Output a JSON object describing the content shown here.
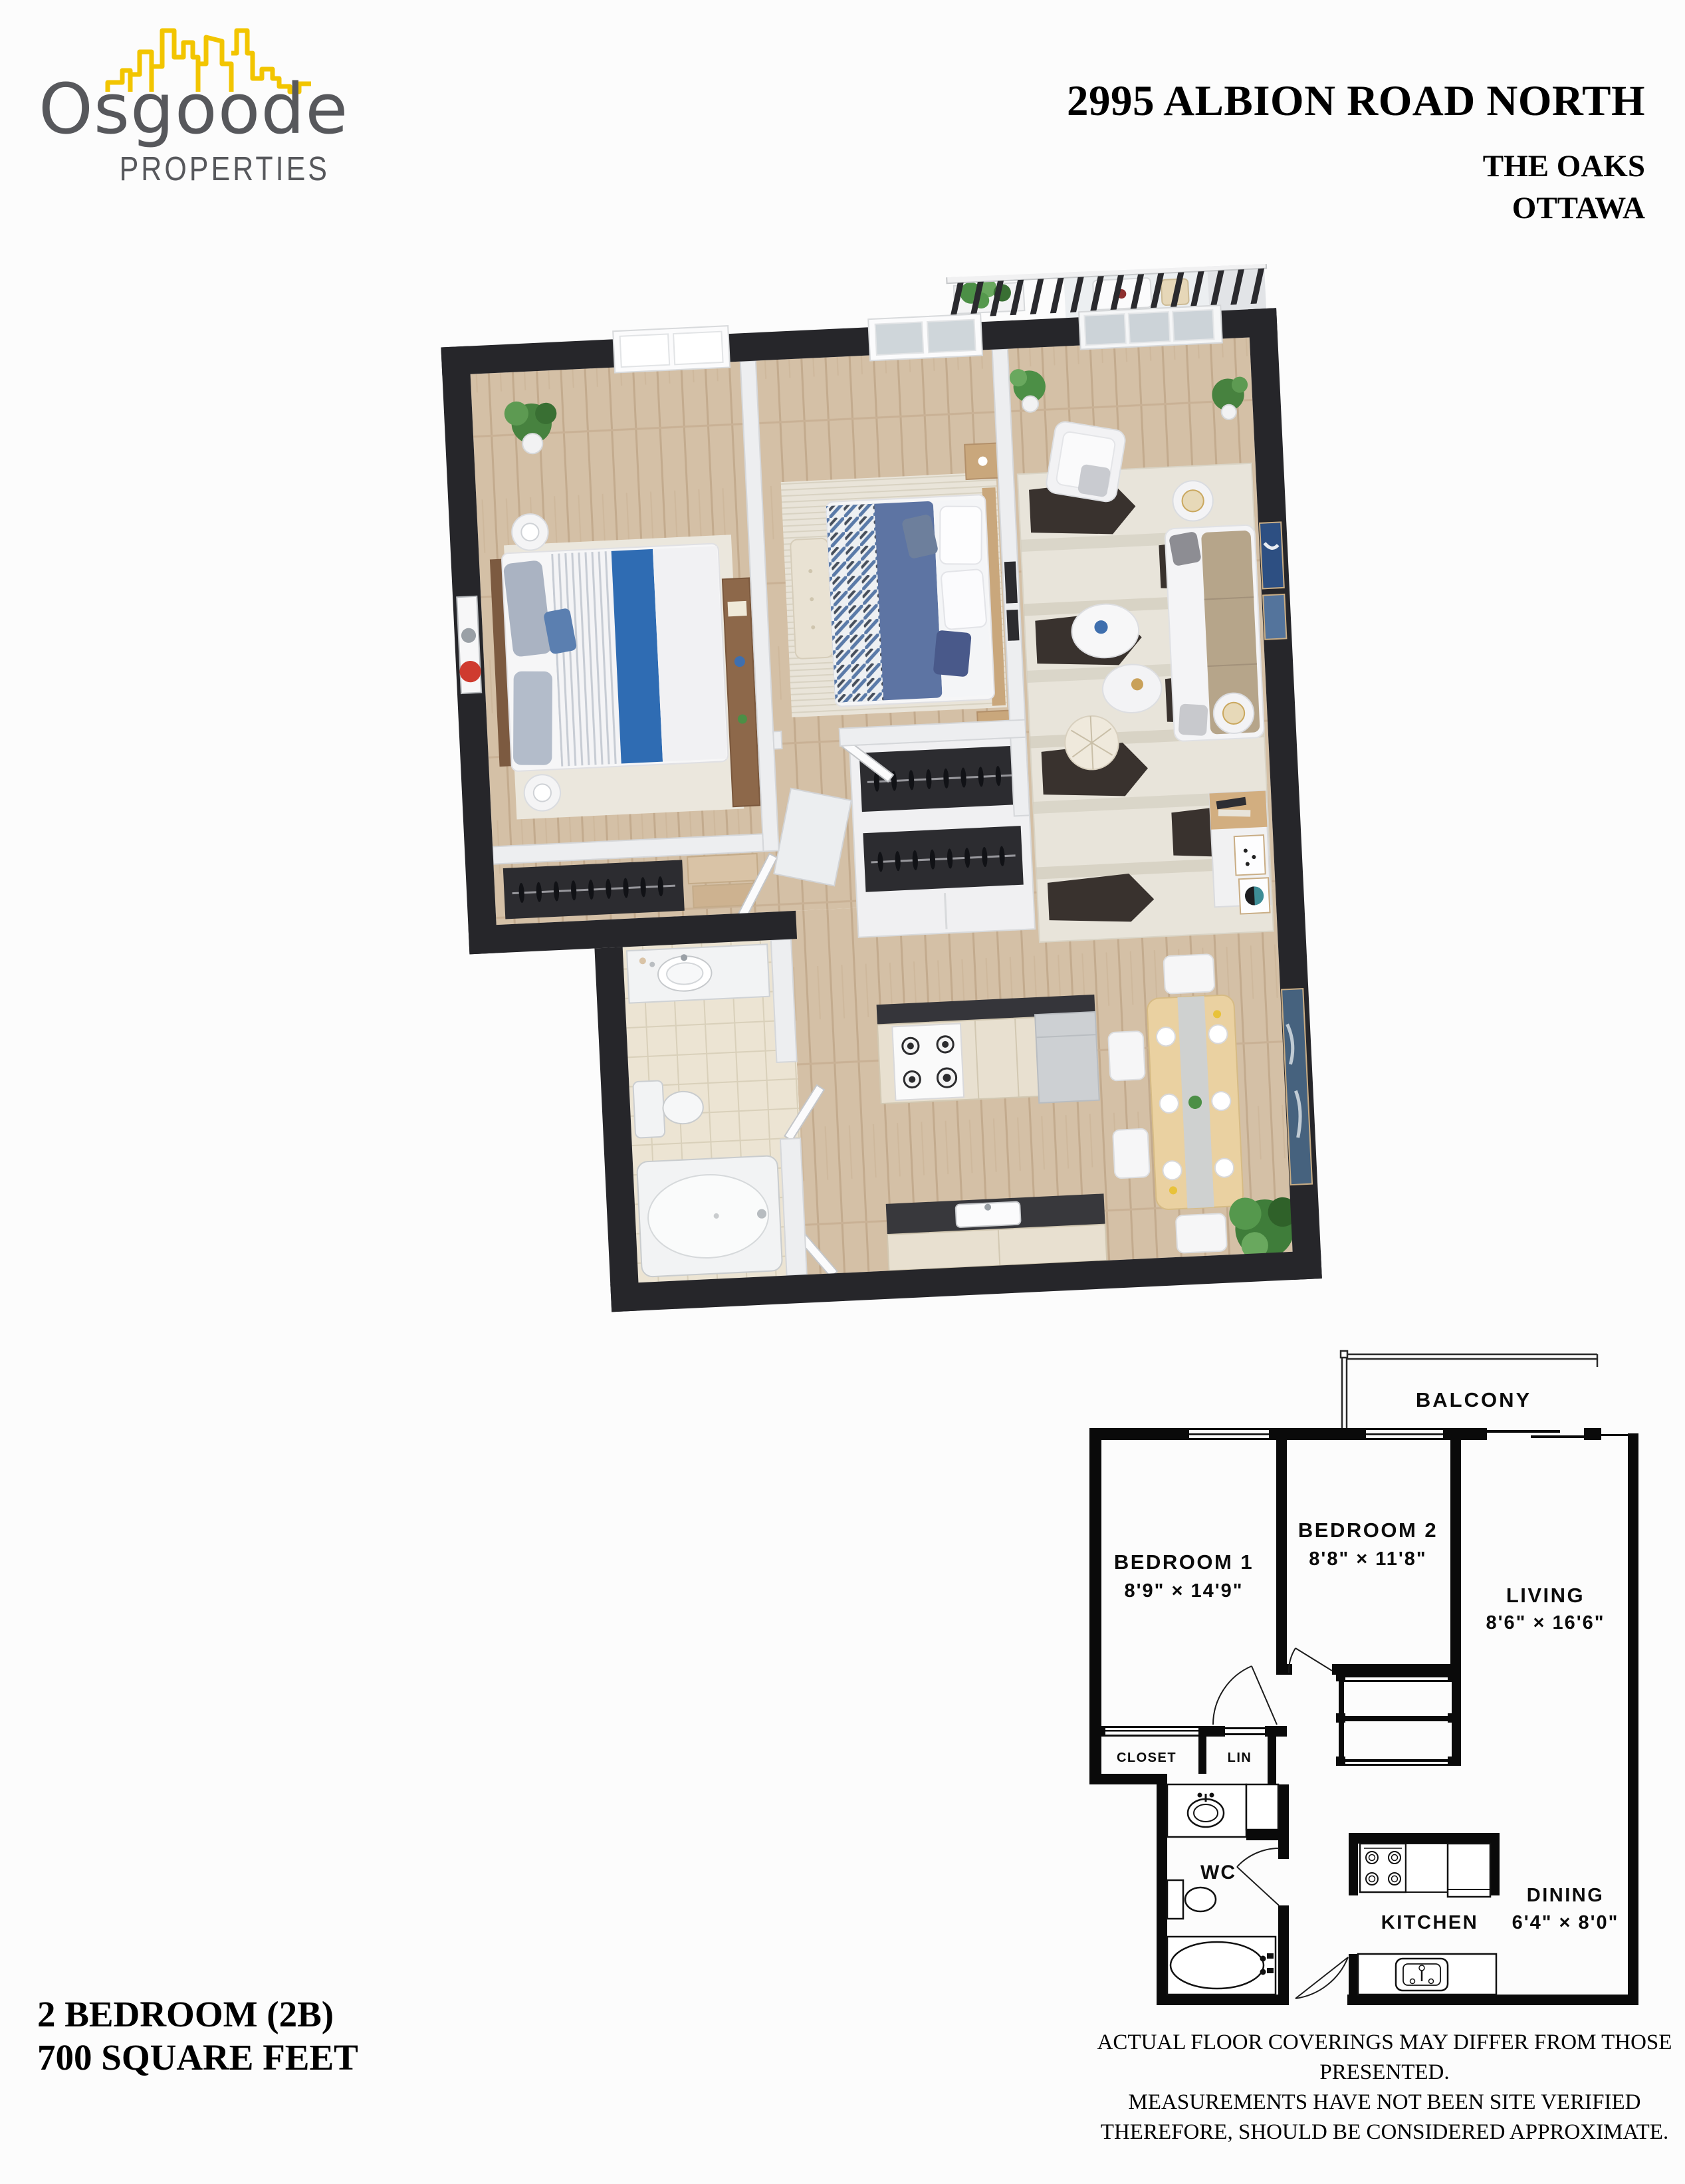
{
  "logo": {
    "name": "Osgoode",
    "tagline": "PROPERTIES",
    "skyline_icon": "city-skyline",
    "skyline_color": "#f2c500",
    "text_color": "#57585c"
  },
  "header": {
    "address": "2995 ALBION ROAD NORTH",
    "building": "THE OAKS",
    "city": "OTTAWA"
  },
  "unit_info": {
    "type": "2 BEDROOM (2B)",
    "area": "700 SQUARE FEET"
  },
  "floorplan_2d": {
    "balcony_label": "BALCONY",
    "rooms": {
      "bedroom1": {
        "label": "BEDROOM 1",
        "dims": "8'9\" × 14'9\""
      },
      "bedroom2": {
        "label": "BEDROOM 2",
        "dims": "8'8\" × 11'8\""
      },
      "living": {
        "label": "LIVING",
        "dims": "8'6\" × 16'6\""
      },
      "dining": {
        "label": "DINING",
        "dims": "6'4\" × 8'0\""
      },
      "kitchen": {
        "label": "KITCHEN"
      },
      "wc": {
        "label": "WC"
      },
      "closet": {
        "label": "CLOSET"
      },
      "linen": {
        "label": "LIN"
      }
    },
    "wall_color": "#0a0a0a"
  },
  "render_3d": {
    "wall_color": "#26262a",
    "floor_wood": "#d4c0a6",
    "floor_tile": "#ece4d3",
    "accent_blue": "#2f6cb3",
    "duvet_blue": "#5d74a3"
  },
  "disclaimer": {
    "line1": "ACTUAL FLOOR COVERINGS MAY DIFFER FROM THOSE PRESENTED.",
    "line2": "MEASUREMENTS HAVE NOT BEEN SITE VERIFIED",
    "line3": "THEREFORE, SHOULD BE CONSIDERED APPROXIMATE."
  }
}
